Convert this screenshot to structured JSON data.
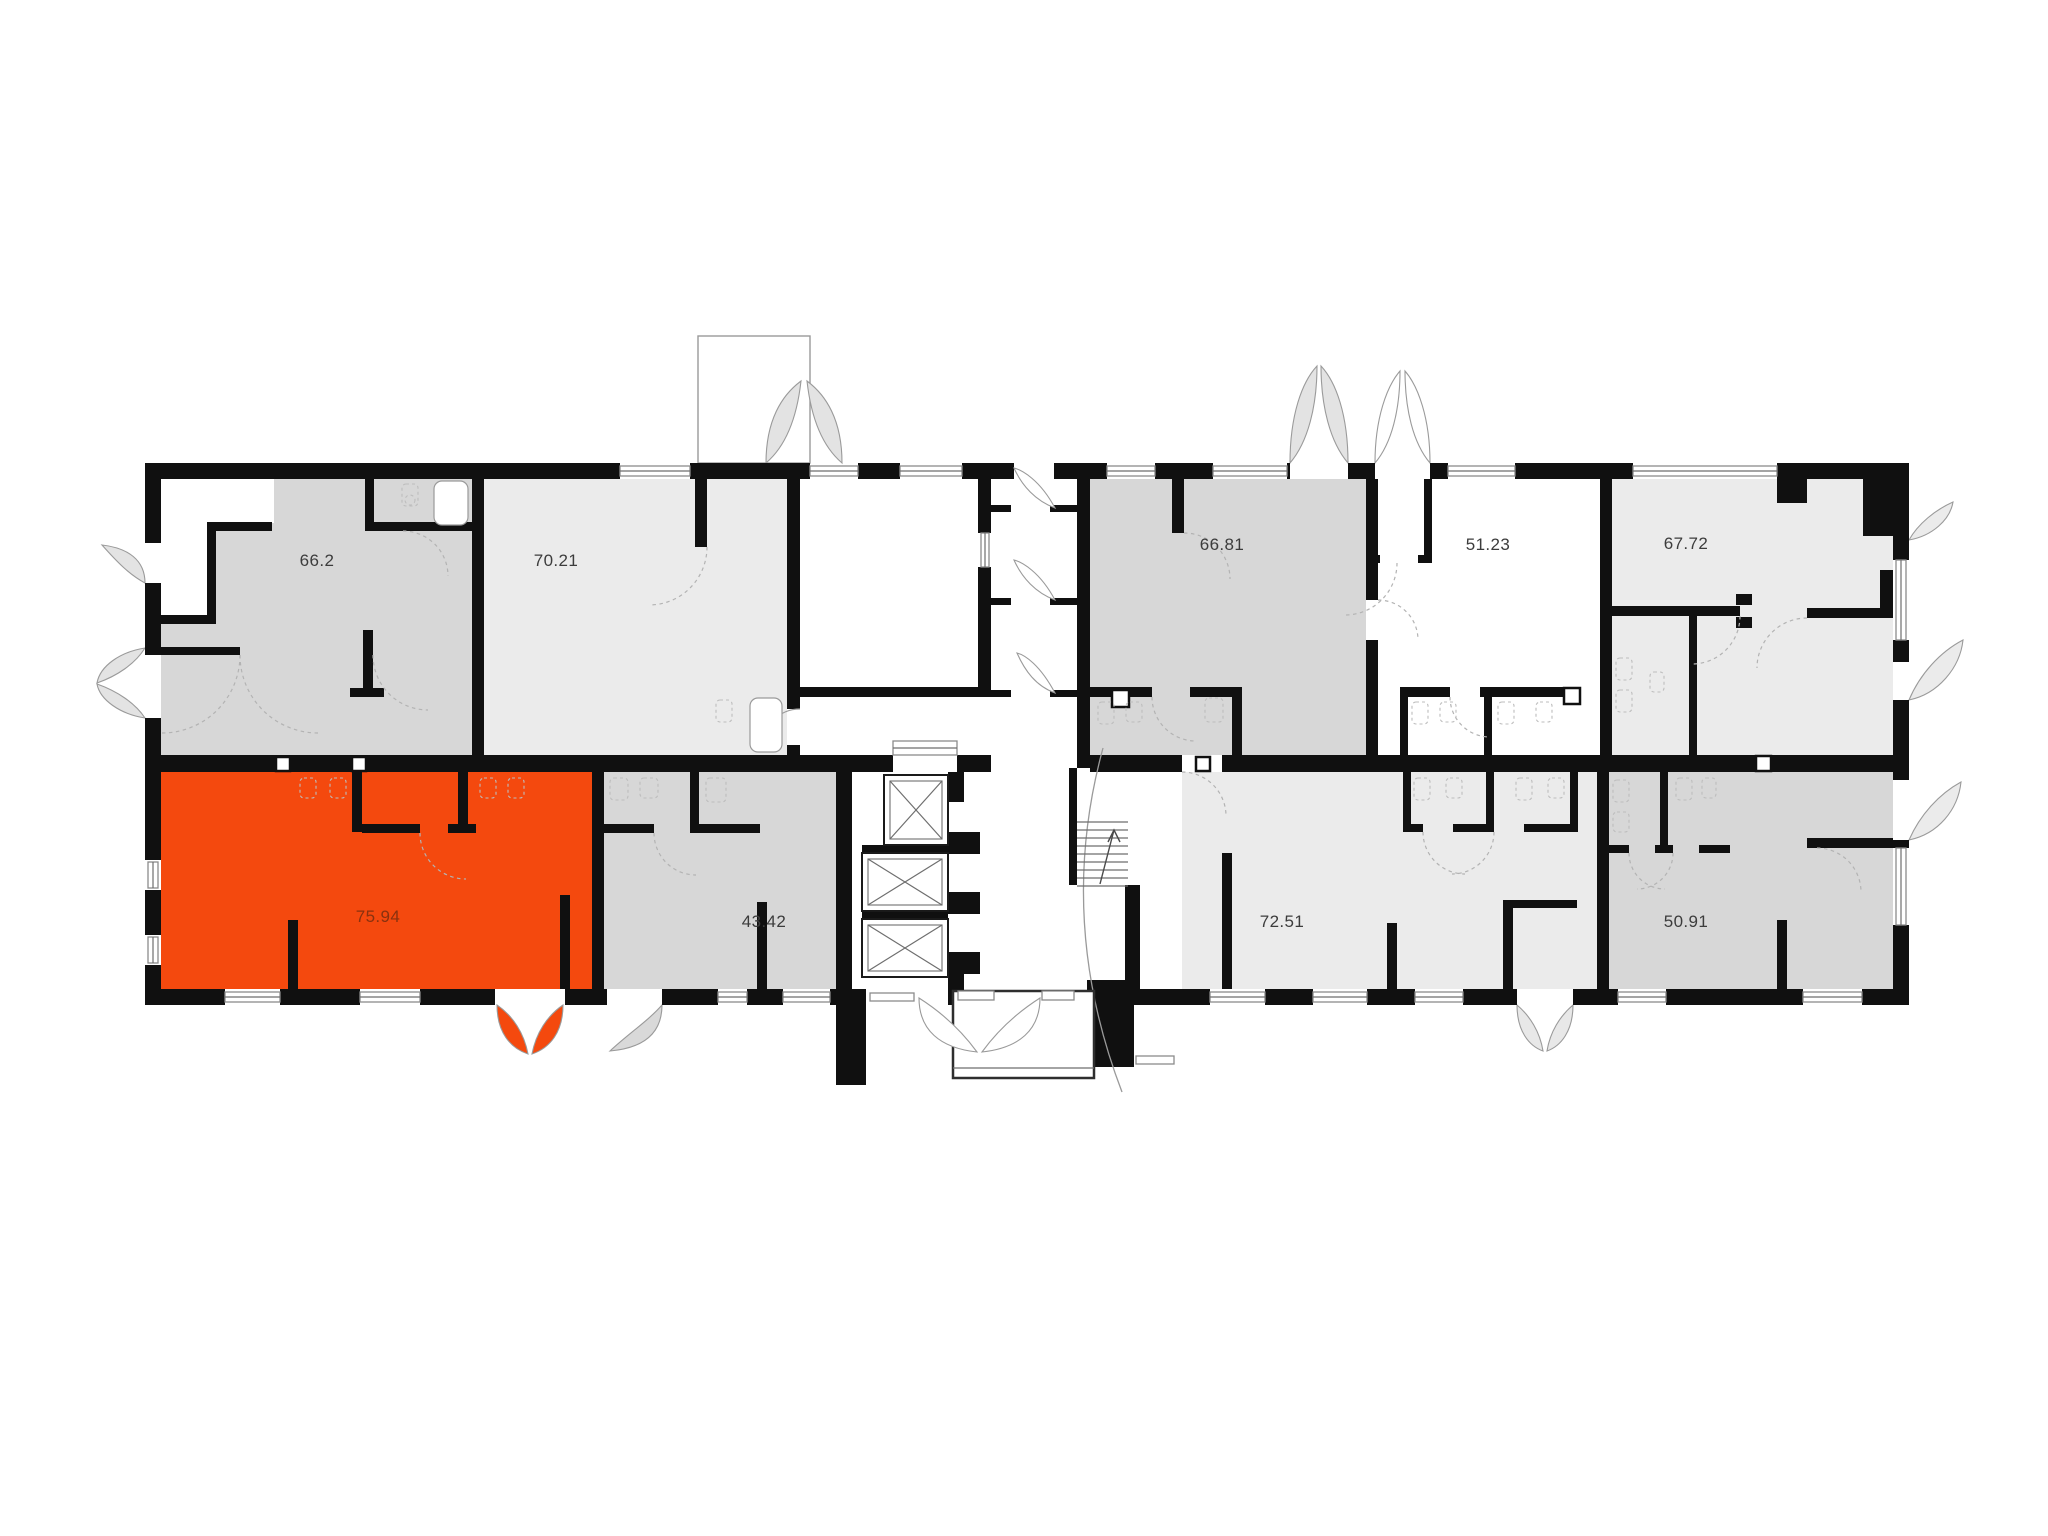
{
  "plan": {
    "name": "Building floor plan",
    "rooms": [
      {
        "id": "unit-66-2",
        "area": "66.2",
        "fill": "gray",
        "highlighted": false
      },
      {
        "id": "unit-70-21",
        "area": "70.21",
        "fill": "light",
        "highlighted": false
      },
      {
        "id": "unit-66-81",
        "area": "66.81",
        "fill": "gray",
        "highlighted": false
      },
      {
        "id": "unit-51-23",
        "area": "51.23",
        "fill": "white",
        "highlighted": false
      },
      {
        "id": "unit-67-72",
        "area": "67.72",
        "fill": "light",
        "highlighted": false
      },
      {
        "id": "unit-75-94",
        "area": "75.94",
        "fill": "highlight",
        "highlighted": true
      },
      {
        "id": "unit-43-42",
        "area": "43.42",
        "fill": "gray",
        "highlighted": false
      },
      {
        "id": "unit-72-51",
        "area": "72.51",
        "fill": "light",
        "highlighted": false
      },
      {
        "id": "unit-50-91",
        "area": "50.91",
        "fill": "gray",
        "highlighted": false
      }
    ],
    "features": {
      "elevators_count": 3,
      "staircase": true,
      "entrance_vestibule": true
    }
  },
  "colors": {
    "highlight": "#F4490E",
    "room_gray": "#d7d7d7",
    "room_light": "#ebebeb",
    "room_white": "#ffffff",
    "wall": "#101010",
    "door_leaf_gray": "#e3e3e3",
    "label": "#3c3c3c",
    "highlight_label": "#6e2c10"
  }
}
